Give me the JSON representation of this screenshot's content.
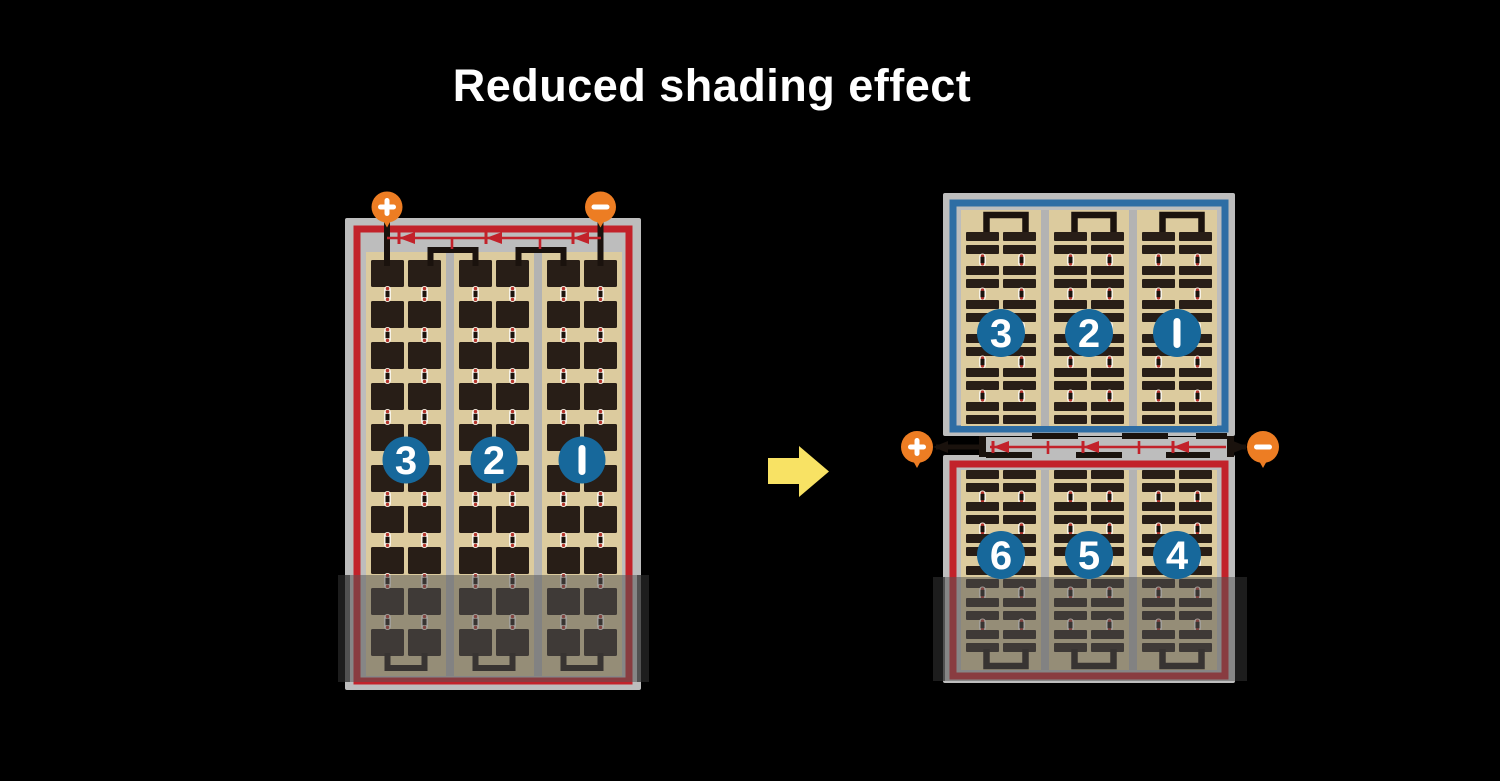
{
  "title": "Reduced shading effect",
  "colors": {
    "background": "#000000",
    "title_text": "#ffffff",
    "panel_frame": "#bdbdbd",
    "column_gap": "#b3b3b3",
    "cell_area": "#dccb9e",
    "cell": "#281e17",
    "wire_black": "#1a120d",
    "circuit_red": "#c2222a",
    "border_blue": "#2e6da4",
    "string_badge_blue": "#17689b",
    "terminal_orange": "#ed7d23",
    "arrow_yellow": "#f8e264",
    "connector_white": "#f7f3e8",
    "connector_dot_red": "#b5342c",
    "shade_overlay": "rgba(85,85,85,0.52)",
    "shade_edge": "rgba(10,10,10,0.42)"
  },
  "left_module": {
    "terminal_plus": "+",
    "terminal_minus": "−",
    "strings": [
      "3",
      "2",
      "1"
    ],
    "bypass_diodes": 3,
    "shaded": true
  },
  "right_module": {
    "terminal_plus": "+",
    "terminal_minus": "−",
    "top_half_strings": [
      "3",
      "2",
      "1"
    ],
    "bottom_half_strings": [
      "6",
      "5",
      "4"
    ],
    "bypass_diodes": 3,
    "shaded": true
  },
  "arrow": {
    "icon": "right-arrow"
  }
}
